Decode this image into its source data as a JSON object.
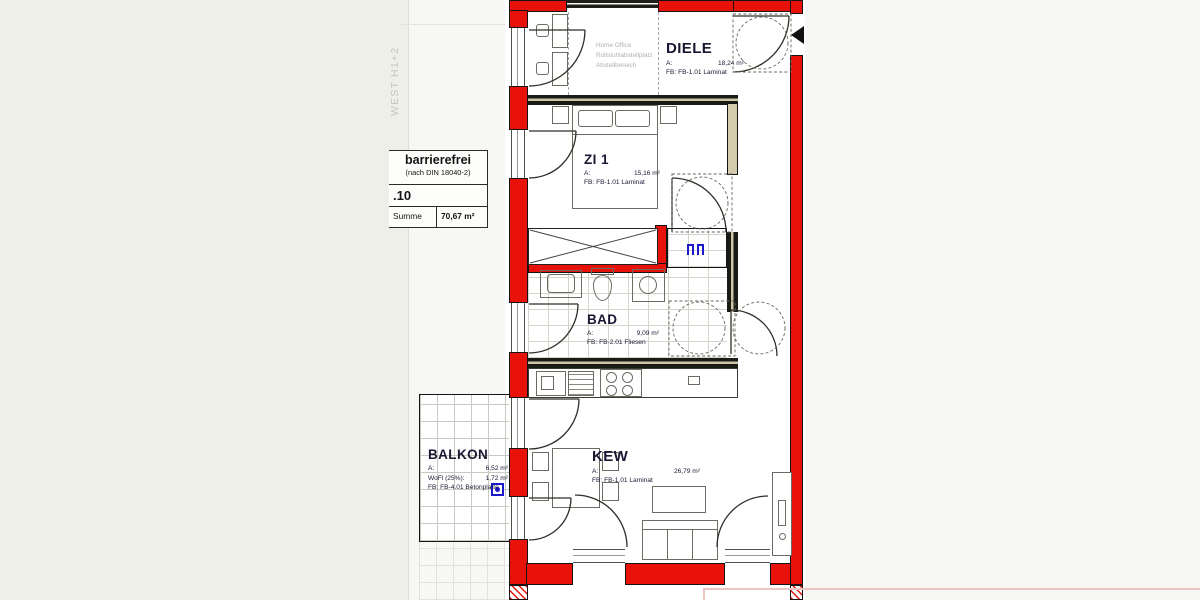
{
  "side_label": "WEST H1+2",
  "title_block": {
    "certification": "barrierefrei",
    "certification_note": "(nach DIN 18040-2)",
    "unit_number": ".10",
    "sum_label": "Summe",
    "sum_value": "70,67 m²"
  },
  "rooms": [
    {
      "name": "DIELE",
      "area_label": "A:",
      "area": "18,24 m²",
      "floor": "FB: FB-1.01 Laminat"
    },
    {
      "name": "ZI 1",
      "area_label": "A:",
      "area": "15,16 m²",
      "floor": "FB: FB-1.01 Laminat"
    },
    {
      "name": "BAD",
      "area_label": "A:",
      "area": "9,09 m²",
      "floor": "FB: FB-2.01 Fliesen"
    },
    {
      "name": "KEW",
      "area_label": "A:",
      "area": "26,79 m²",
      "floor": "FB: FB-1.01 Laminat"
    },
    {
      "name": "BALKON",
      "area_label": "A:",
      "area": "6,52 m²",
      "wofl_label": "WoFl (25%):",
      "wofl_value": "1,72 m²",
      "floor": "FB: FB-4.01 Betonplatte"
    }
  ],
  "zone_note": {
    "line1": "Home Office",
    "line2": "Rollstuhlabstellplatz",
    "line3": "Abstellbereich"
  },
  "colors": {
    "wall_red": "#e8120b",
    "annotation_blue": "#1a1acc",
    "label_ink": "#181832",
    "muted_grey": "#b0b0ac"
  }
}
